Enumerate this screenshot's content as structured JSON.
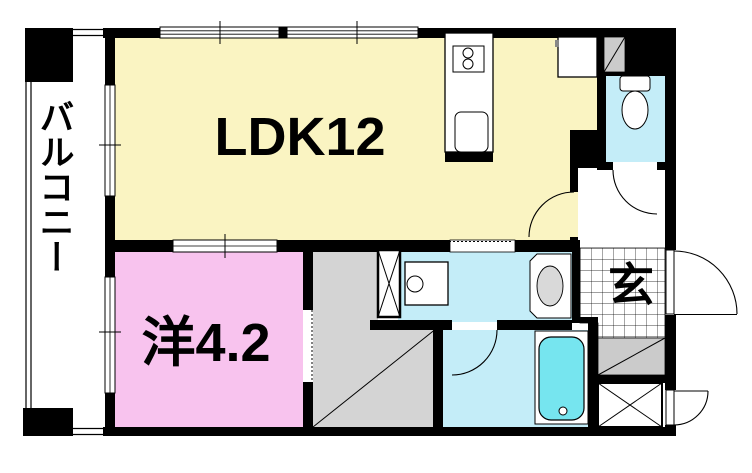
{
  "floorplan": {
    "rooms": {
      "ldk": {
        "label": "LDK12"
      },
      "western_room": {
        "label": "洋4.2"
      },
      "entrance": {
        "label": "玄"
      },
      "balcony": {
        "label": "バルコニー"
      }
    },
    "colors": {
      "ldk": "#FAF4C2",
      "western_room": "#F8C3EE",
      "wet_area": "#C4EDF8",
      "bathtub": "#76E5EF",
      "hall_gray": "#D4D4D4",
      "storage_gray": "#CBCBCB",
      "wall": "#000000"
    }
  }
}
